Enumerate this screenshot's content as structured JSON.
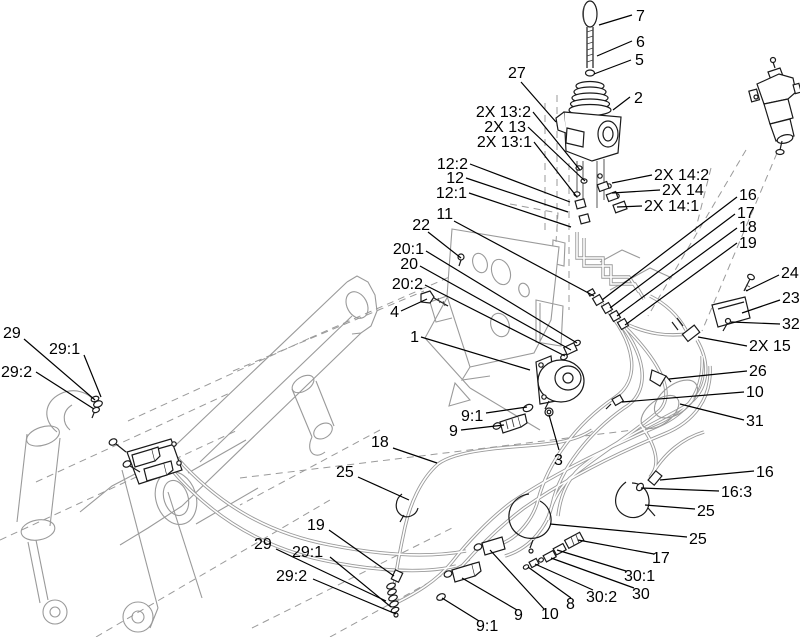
{
  "diagram": {
    "type": "exploded-parts-diagram",
    "background": "#ffffff",
    "line_color": "#000000",
    "ghost_color": "#9a9a9a",
    "hose_color": "#9a9a9a",
    "label_font_px": 16,
    "callouts": [
      {
        "text": "7",
        "x": 636,
        "y": 21,
        "a": "start",
        "l": [
          632,
          15,
          599,
          25
        ]
      },
      {
        "text": "6",
        "x": 636,
        "y": 47,
        "a": "start",
        "l": [
          632,
          41,
          597,
          56
        ]
      },
      {
        "text": "5",
        "x": 635,
        "y": 65,
        "a": "start",
        "l": [
          631,
          60,
          594,
          74
        ]
      },
      {
        "text": "2",
        "x": 634,
        "y": 103,
        "a": "start",
        "l": [
          630,
          97,
          613,
          110
        ]
      },
      {
        "text": "27",
        "x": 508,
        "y": 78,
        "a": "start",
        "l": [
          521,
          82,
          556,
          122
        ]
      },
      {
        "text": "2X 13:2",
        "x": 531,
        "y": 117,
        "a": "end",
        "l": [
          533,
          112,
          580,
          170
        ]
      },
      {
        "text": "2X 13",
        "x": 526,
        "y": 132,
        "a": "end",
        "l": [
          528,
          127,
          585,
          181
        ]
      },
      {
        "text": "2X 13:1",
        "x": 532,
        "y": 147,
        "a": "end",
        "l": [
          534,
          142,
          577,
          197
        ]
      },
      {
        "text": "12:2",
        "x": 468,
        "y": 169,
        "a": "end",
        "l": [
          470,
          164,
          570,
          202
        ]
      },
      {
        "text": "12",
        "x": 464,
        "y": 183,
        "a": "end",
        "l": [
          466,
          178,
          568,
          212
        ]
      },
      {
        "text": "12:1",
        "x": 467,
        "y": 198,
        "a": "end",
        "l": [
          469,
          193,
          571,
          227
        ]
      },
      {
        "text": "11",
        "x": 453,
        "y": 219,
        "a": "end",
        "l": [
          454,
          221,
          594,
          296
        ]
      },
      {
        "text": "22",
        "x": 430,
        "y": 230,
        "a": "end",
        "l": [
          428,
          232,
          461,
          258
        ]
      },
      {
        "text": "20:1",
        "x": 424,
        "y": 254,
        "a": "end",
        "l": [
          426,
          251,
          577,
          343
        ]
      },
      {
        "text": "20",
        "x": 418,
        "y": 269,
        "a": "end",
        "l": [
          420,
          266,
          571,
          350
        ]
      },
      {
        "text": "20:2",
        "x": 423,
        "y": 289,
        "a": "end",
        "l": [
          425,
          285,
          565,
          356
        ]
      },
      {
        "text": "4",
        "x": 399,
        "y": 317,
        "a": "end",
        "l": [
          401,
          311,
          427,
          299
        ]
      },
      {
        "text": "1",
        "x": 419,
        "y": 342,
        "a": "end",
        "l": [
          421,
          337,
          530,
          370
        ]
      },
      {
        "text": "2X 14:2",
        "x": 654,
        "y": 180,
        "a": "start",
        "l": [
          652,
          175,
          612,
          183
        ]
      },
      {
        "text": "2X 14",
        "x": 662,
        "y": 195,
        "a": "start",
        "l": [
          660,
          190,
          612,
          193
        ]
      },
      {
        "text": "2X 14:1",
        "x": 644,
        "y": 211,
        "a": "start",
        "l": [
          642,
          206,
          617,
          207
        ]
      },
      {
        "text": "16",
        "x": 739,
        "y": 200,
        "a": "start",
        "l": [
          737,
          197,
          602,
          300
        ]
      },
      {
        "text": "17",
        "x": 737,
        "y": 218,
        "a": "start",
        "l": [
          735,
          214,
          610,
          308
        ]
      },
      {
        "text": "18",
        "x": 739,
        "y": 232,
        "a": "start",
        "l": [
          737,
          228,
          617,
          316
        ]
      },
      {
        "text": "19",
        "x": 739,
        "y": 248,
        "a": "start",
        "l": [
          737,
          243,
          625,
          325
        ]
      },
      {
        "text": "24",
        "x": 781,
        "y": 278,
        "a": "start",
        "l": [
          779,
          275,
          746,
          291
        ]
      },
      {
        "text": "23",
        "x": 782,
        "y": 303,
        "a": "start",
        "l": [
          780,
          300,
          742,
          313
        ]
      },
      {
        "text": "32",
        "x": 782,
        "y": 329,
        "a": "start",
        "l": [
          780,
          324,
          731,
          322
        ]
      },
      {
        "text": "2X 15",
        "x": 749,
        "y": 351,
        "a": "start",
        "l": [
          747,
          346,
          698,
          337
        ]
      },
      {
        "text": "26",
        "x": 749,
        "y": 376,
        "a": "start",
        "l": [
          747,
          371,
          669,
          379
        ]
      },
      {
        "text": "10",
        "x": 746,
        "y": 397,
        "a": "start",
        "l": [
          744,
          392,
          622,
          402
        ]
      },
      {
        "text": "31",
        "x": 746,
        "y": 426,
        "a": "start",
        "l": [
          744,
          420,
          680,
          404
        ]
      },
      {
        "text": "29",
        "x": 3,
        "y": 338,
        "a": "start",
        "l": [
          24,
          339,
          95,
          400
        ]
      },
      {
        "text": "29:1",
        "x": 49,
        "y": 354,
        "a": "start",
        "l": [
          84,
          355,
          101,
          397
        ]
      },
      {
        "text": "29:2",
        "x": 1,
        "y": 377,
        "a": "start",
        "l": [
          36,
          372,
          94,
          409
        ]
      },
      {
        "text": "9:1",
        "x": 461,
        "y": 421,
        "a": "start",
        "l": [
          486,
          413,
          527,
          407
        ]
      },
      {
        "text": "9",
        "x": 449,
        "y": 436,
        "a": "start",
        "l": [
          461,
          430,
          504,
          425
        ]
      },
      {
        "text": "3",
        "x": 554,
        "y": 465,
        "a": "start",
        "l": [
          559,
          450,
          549,
          415
        ]
      },
      {
        "text": "18",
        "x": 371,
        "y": 447,
        "a": "start",
        "l": [
          393,
          448,
          437,
          463
        ]
      },
      {
        "text": "25",
        "x": 336,
        "y": 477,
        "a": "start",
        "l": [
          358,
          477,
          409,
          500
        ]
      },
      {
        "text": "19",
        "x": 307,
        "y": 530,
        "a": "start",
        "l": [
          329,
          530,
          394,
          576
        ]
      },
      {
        "text": "29",
        "x": 254,
        "y": 549,
        "a": "start",
        "l": [
          276,
          549,
          386,
          601
        ]
      },
      {
        "text": "29:1",
        "x": 292,
        "y": 557,
        "a": "start",
        "l": [
          330,
          557,
          391,
          607
        ]
      },
      {
        "text": "29:2",
        "x": 276,
        "y": 581,
        "a": "start",
        "l": [
          313,
          579,
          396,
          614
        ]
      },
      {
        "text": "9:1",
        "x": 476,
        "y": 631,
        "a": "start",
        "l": [
          479,
          621,
          442,
          598
        ]
      },
      {
        "text": "9",
        "x": 514,
        "y": 620,
        "a": "start",
        "l": [
          517,
          610,
          462,
          578
        ]
      },
      {
        "text": "10",
        "x": 541,
        "y": 619,
        "a": "start",
        "l": [
          544,
          609,
          490,
          550
        ]
      },
      {
        "text": "8",
        "x": 566,
        "y": 609,
        "a": "start",
        "l": [
          571,
          598,
          528,
          567
        ]
      },
      {
        "text": "30:2",
        "x": 586,
        "y": 602,
        "a": "start",
        "l": [
          593,
          590,
          535,
          564
        ]
      },
      {
        "text": "30",
        "x": 632,
        "y": 599,
        "a": "start",
        "l": [
          634,
          588,
          551,
          558
        ]
      },
      {
        "text": "30:1",
        "x": 624,
        "y": 581,
        "a": "start",
        "l": [
          626,
          571,
          557,
          550
        ]
      },
      {
        "text": "17",
        "x": 652,
        "y": 563,
        "a": "start",
        "l": [
          654,
          554,
          578,
          540
        ]
      },
      {
        "text": "25",
        "x": 689,
        "y": 544,
        "a": "start",
        "l": [
          687,
          537,
          550,
          524
        ]
      },
      {
        "text": "25",
        "x": 697,
        "y": 516,
        "a": "start",
        "l": [
          695,
          509,
          645,
          505
        ]
      },
      {
        "text": "16:3",
        "x": 721,
        "y": 497,
        "a": "start",
        "l": [
          719,
          491,
          641,
          488
        ]
      },
      {
        "text": "16",
        "x": 756,
        "y": 477,
        "a": "start",
        "l": [
          754,
          471,
          660,
          480
        ]
      }
    ]
  }
}
